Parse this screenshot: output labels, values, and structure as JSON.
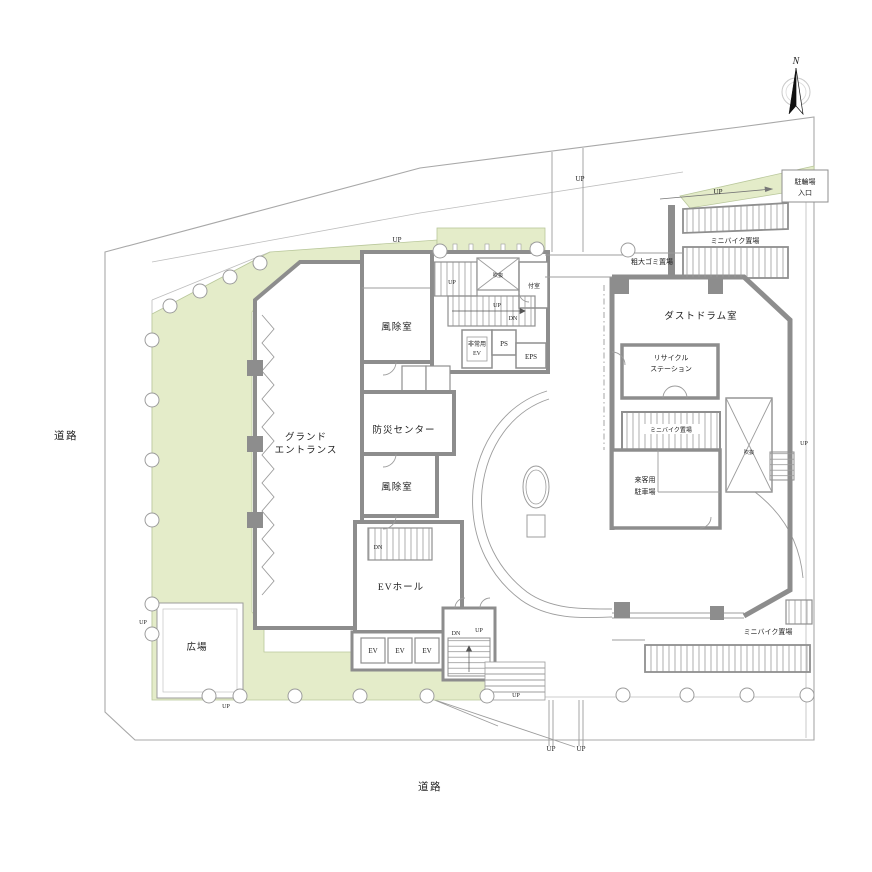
{
  "compass": {
    "north": "N"
  },
  "site": {
    "road_left": "道路",
    "road_bottom": "道路",
    "plaza": "広場"
  },
  "rooms": {
    "grand_entrance_1": "グランド",
    "grand_entrance_2": "エントランス",
    "windbreak": "風除室",
    "disaster_center": "防災センター",
    "ev_hall": "EVホール",
    "ev": "EV",
    "emergency_ev_1": "非常用",
    "emergency_ev_2": "EV",
    "ps": "PS",
    "eps": "EPS",
    "attached_room": "付室",
    "void": "吹抜",
    "dust_drum": "ダストドラム室",
    "recycle_1": "リサイクル",
    "recycle_2": "ステーション",
    "mini_bike": "ミニバイク置場",
    "bulky_garbage": "粗大ゴミ置場",
    "bike_entrance_1": "駐輪場",
    "bike_entrance_2": "入口",
    "visitor_parking_1": "来客用",
    "visitor_parking_2": "駐車場"
  },
  "stairs": {
    "up": "UP",
    "dn": "DN"
  },
  "colors": {
    "landscape_green": "#e4ecc9",
    "wall_gray": "#8d8d8d",
    "line_gray": "#9c9c9c",
    "text": "#222222"
  }
}
